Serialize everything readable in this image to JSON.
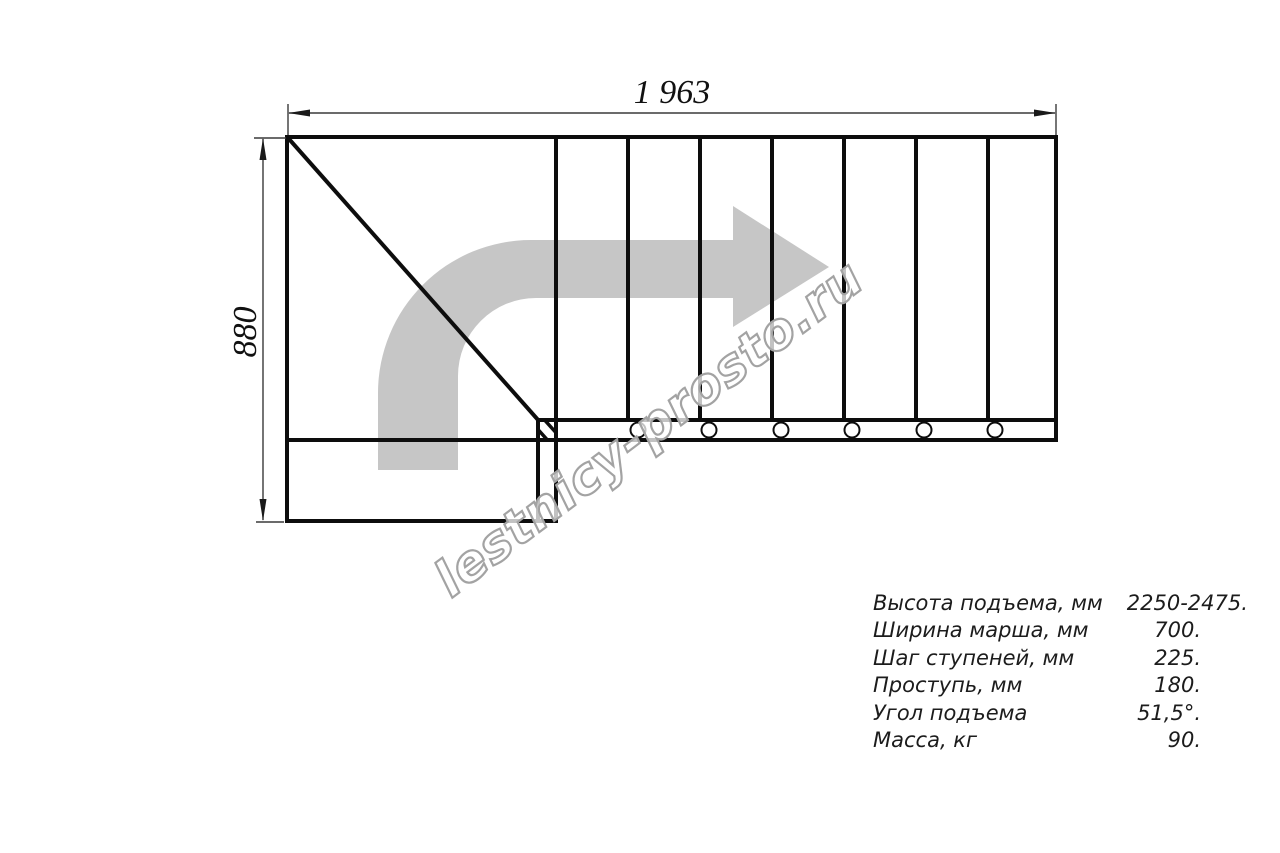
{
  "drawing": {
    "top_dimension": "1 963",
    "left_dimension": "880",
    "arrow_color": "#c6c6c6",
    "line_color": "#0d0d0d"
  },
  "watermark": {
    "text": "lestnicy-prosto.ru"
  },
  "specs": {
    "rows": [
      {
        "label": "Высота подъема, мм",
        "value": "2250-2475."
      },
      {
        "label": "Ширина марша, мм",
        "value": "700."
      },
      {
        "label": "Шаг ступеней, мм",
        "value": "225."
      },
      {
        "label": "Проступь, мм",
        "value": "180."
      },
      {
        "label": "Угол подъема",
        "value": "51,5°."
      },
      {
        "label": "Масса, кг",
        "value": "90."
      }
    ]
  }
}
